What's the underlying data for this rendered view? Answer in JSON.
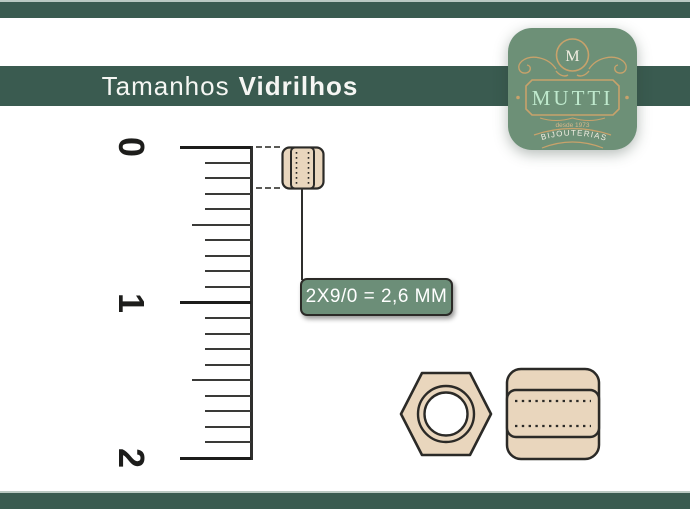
{
  "header": {
    "title_light": "Tamanhos",
    "title_bold": "Vidrilhos"
  },
  "logo": {
    "monogram": "M",
    "brand": "MUTTI",
    "since": "desde 1973",
    "category": "BIJOUTERIAS"
  },
  "ruler": {
    "labels": [
      "0",
      "1",
      "2"
    ],
    "subdivisions": 10
  },
  "size_label": {
    "text": "2X9/0 = 2,6 MM"
  },
  "icons": {
    "bead_small": "bugle-bead-side-view",
    "bead_hex": "hexagonal-bead-front-view",
    "bead_cyl": "cylinder-bead-side-view"
  },
  "colors": {
    "dark_green": "#3a5b50",
    "logo_green": "#6d9077",
    "label_green": "#6c8e78",
    "gold": "#c8a26b",
    "mint": "#bfe9cd",
    "bead_tan": "#e9d6bd",
    "outline": "#2b2a27",
    "separator": "#bac9c2"
  }
}
